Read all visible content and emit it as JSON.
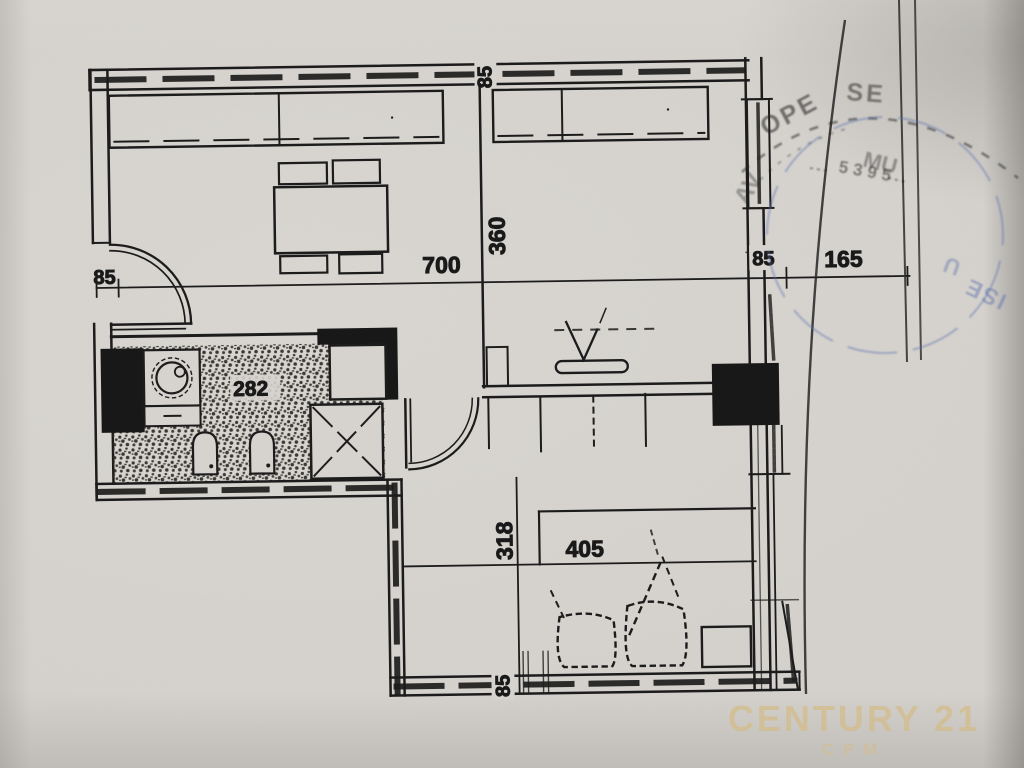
{
  "plan": {
    "dimensions": {
      "top_wall_thickness": "85",
      "living_width": "700",
      "living_depth": "360",
      "entry_side": "85",
      "right_wall_thickness": "85",
      "right_extension": "165",
      "bathroom_width": "282",
      "bedroom_depth": "318",
      "bedroom_width": "405",
      "bottom_wall_thickness": "85"
    }
  },
  "stamps": {
    "black_arc_left": "OPE",
    "black_arc_right": "SE",
    "black_arc_small": "MU",
    "black_numbers": "5395",
    "black_lower": "AV",
    "blue_fragment": "ISE",
    "blue_fragment_2": "U"
  },
  "watermark": {
    "brand": "CENTURY 21",
    "sub": "CPM"
  },
  "colors": {
    "ink": "#1c1c1c",
    "paper": "#d6d3ce",
    "stamp_blue": "#6276ae",
    "watermark_gold": "#d3bd8d"
  }
}
